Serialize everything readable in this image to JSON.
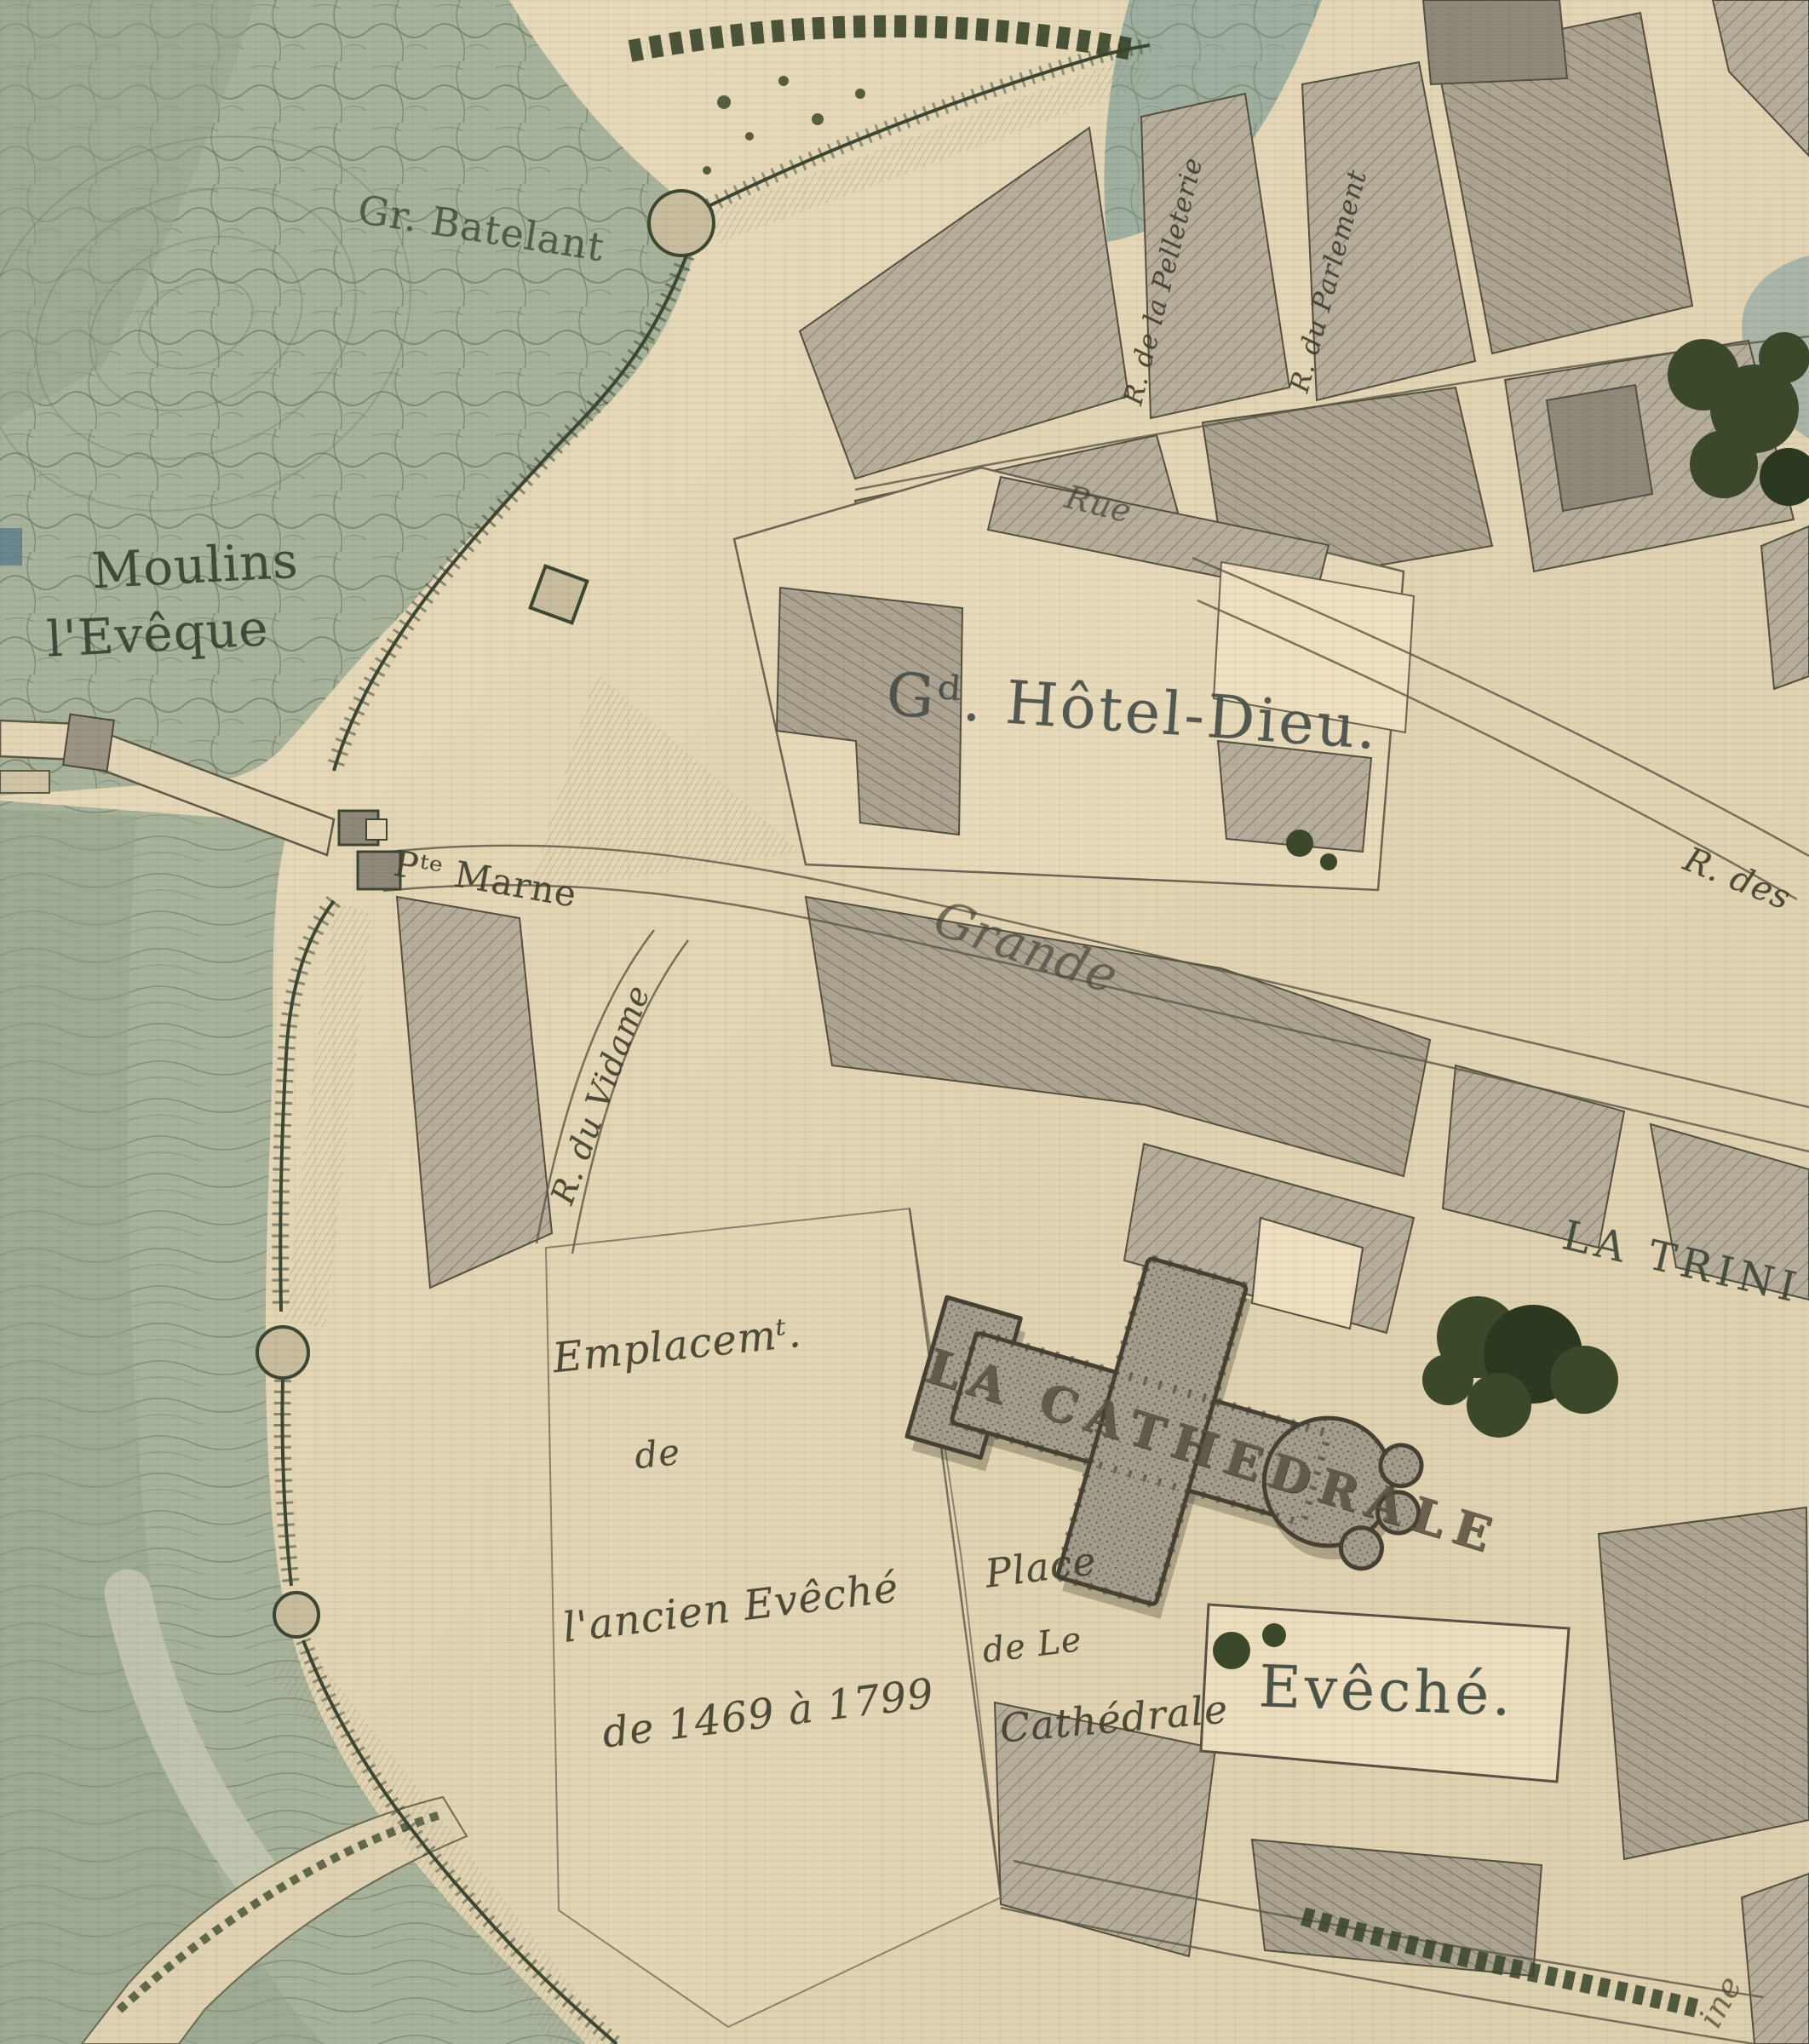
{
  "map": {
    "labels": {
      "batelant": {
        "text": "Gr. Batelant"
      },
      "moulins_line1": {
        "text": "Moulins"
      },
      "moulins_line2": {
        "text": "l'Evêque"
      },
      "hotel_dieu": {
        "text": "Gᵈ. Hôtel-Dieu."
      },
      "rue_top": {
        "text": "Rue"
      },
      "rue_pelleterie": {
        "text": "R. de la Pelleterie"
      },
      "rue_parlement": {
        "text": "R. du Parlement"
      },
      "porte_marne": {
        "text": "Pᵗᵉ Marne"
      },
      "grande": {
        "text": "Grande"
      },
      "rue_des": {
        "text": "R. des"
      },
      "rue_vidame": {
        "text": "R. du Vidame"
      },
      "emplacement_l1": {
        "text": "Emplacemᵗ."
      },
      "emplacement_l2": {
        "text": "de"
      },
      "emplacement_l3": {
        "text": "l'ancien Evêché"
      },
      "emplacement_l4": {
        "text": "de 1469 à 1799"
      },
      "cathedrale": {
        "text": "LA CATHEDRALE"
      },
      "place_l1": {
        "text": "Place"
      },
      "place_l2": {
        "text": "de Le"
      },
      "place_l3": {
        "text": "Cathédrale"
      },
      "eveche": {
        "text": "Evêché."
      },
      "trinite": {
        "text": "LA TRINI"
      },
      "fragment_ine": {
        "text": "ine"
      }
    },
    "colors": {
      "parchment": "#e6d9ba",
      "water": "#a8b39b",
      "water_dark": "#94a48b",
      "block_hatch": "#b5ac99",
      "block_dark": "#8f897c",
      "tree_green": "#3c4a2b",
      "ink": "#42402f",
      "wall_ink": "#3d4834"
    }
  }
}
